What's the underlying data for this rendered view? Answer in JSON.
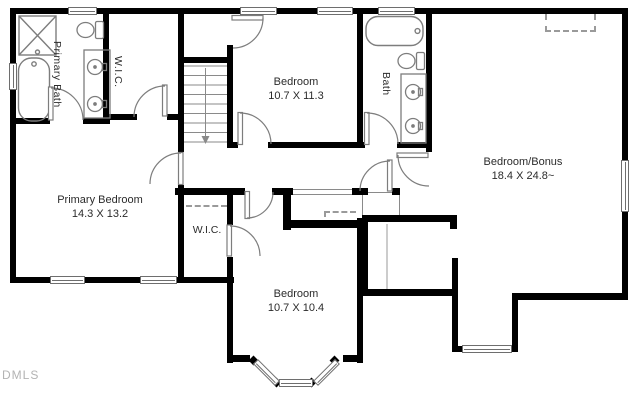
{
  "watermark": "DMLS",
  "colors": {
    "wall": "#000000",
    "fixture": "#7d7d7d",
    "text": "#2b2b2b",
    "watermark": "#b3b3b3"
  },
  "rooms": {
    "primary_bath": {
      "label": "Primary Bath"
    },
    "primary_wic": {
      "label": "W.I.C."
    },
    "bedroom_top": {
      "name": "Bedroom",
      "dims": "10.7 X 11.3"
    },
    "bath": {
      "label": "Bath"
    },
    "bonus": {
      "name": "Bedroom/Bonus",
      "dims": "18.4 X 24.8~"
    },
    "primary_bedroom": {
      "name": "Primary Bedroom",
      "dims": "14.3 X 13.2"
    },
    "wic2": {
      "label": "W.I.C."
    },
    "bedroom_bottom": {
      "name": "Bedroom",
      "dims": "10.7 X 10.4"
    }
  }
}
